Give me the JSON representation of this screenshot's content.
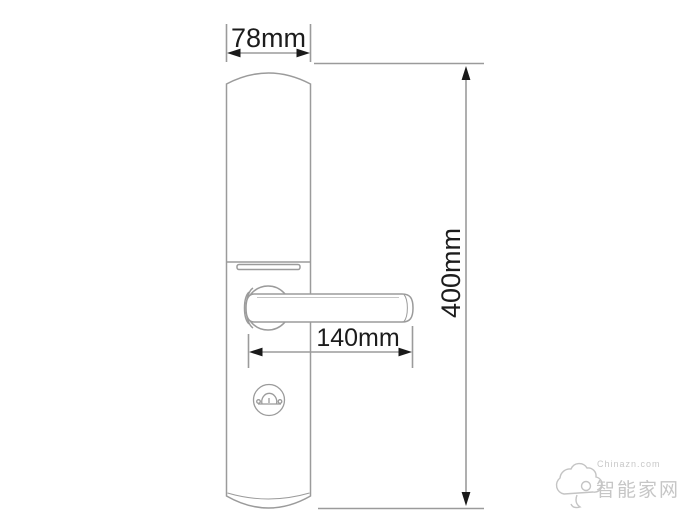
{
  "diagram": {
    "subject": "smart-door-lock-front-view-dimension-drawing",
    "outline_color": "#9b9b9b",
    "dimension_line_color": "#9b9b9b",
    "arrow_color": "#1a1a1a",
    "text_color": "#1c1c1c",
    "background_color": "#ffffff"
  },
  "dimensions": {
    "width_label": "78mm",
    "height_label": "400mm",
    "handle_length_label": "140mm"
  },
  "watermark": {
    "logo": "cloud-logo",
    "line1": "Chinazn.com",
    "line2": "智能家网",
    "color": "#c8c8c8"
  }
}
